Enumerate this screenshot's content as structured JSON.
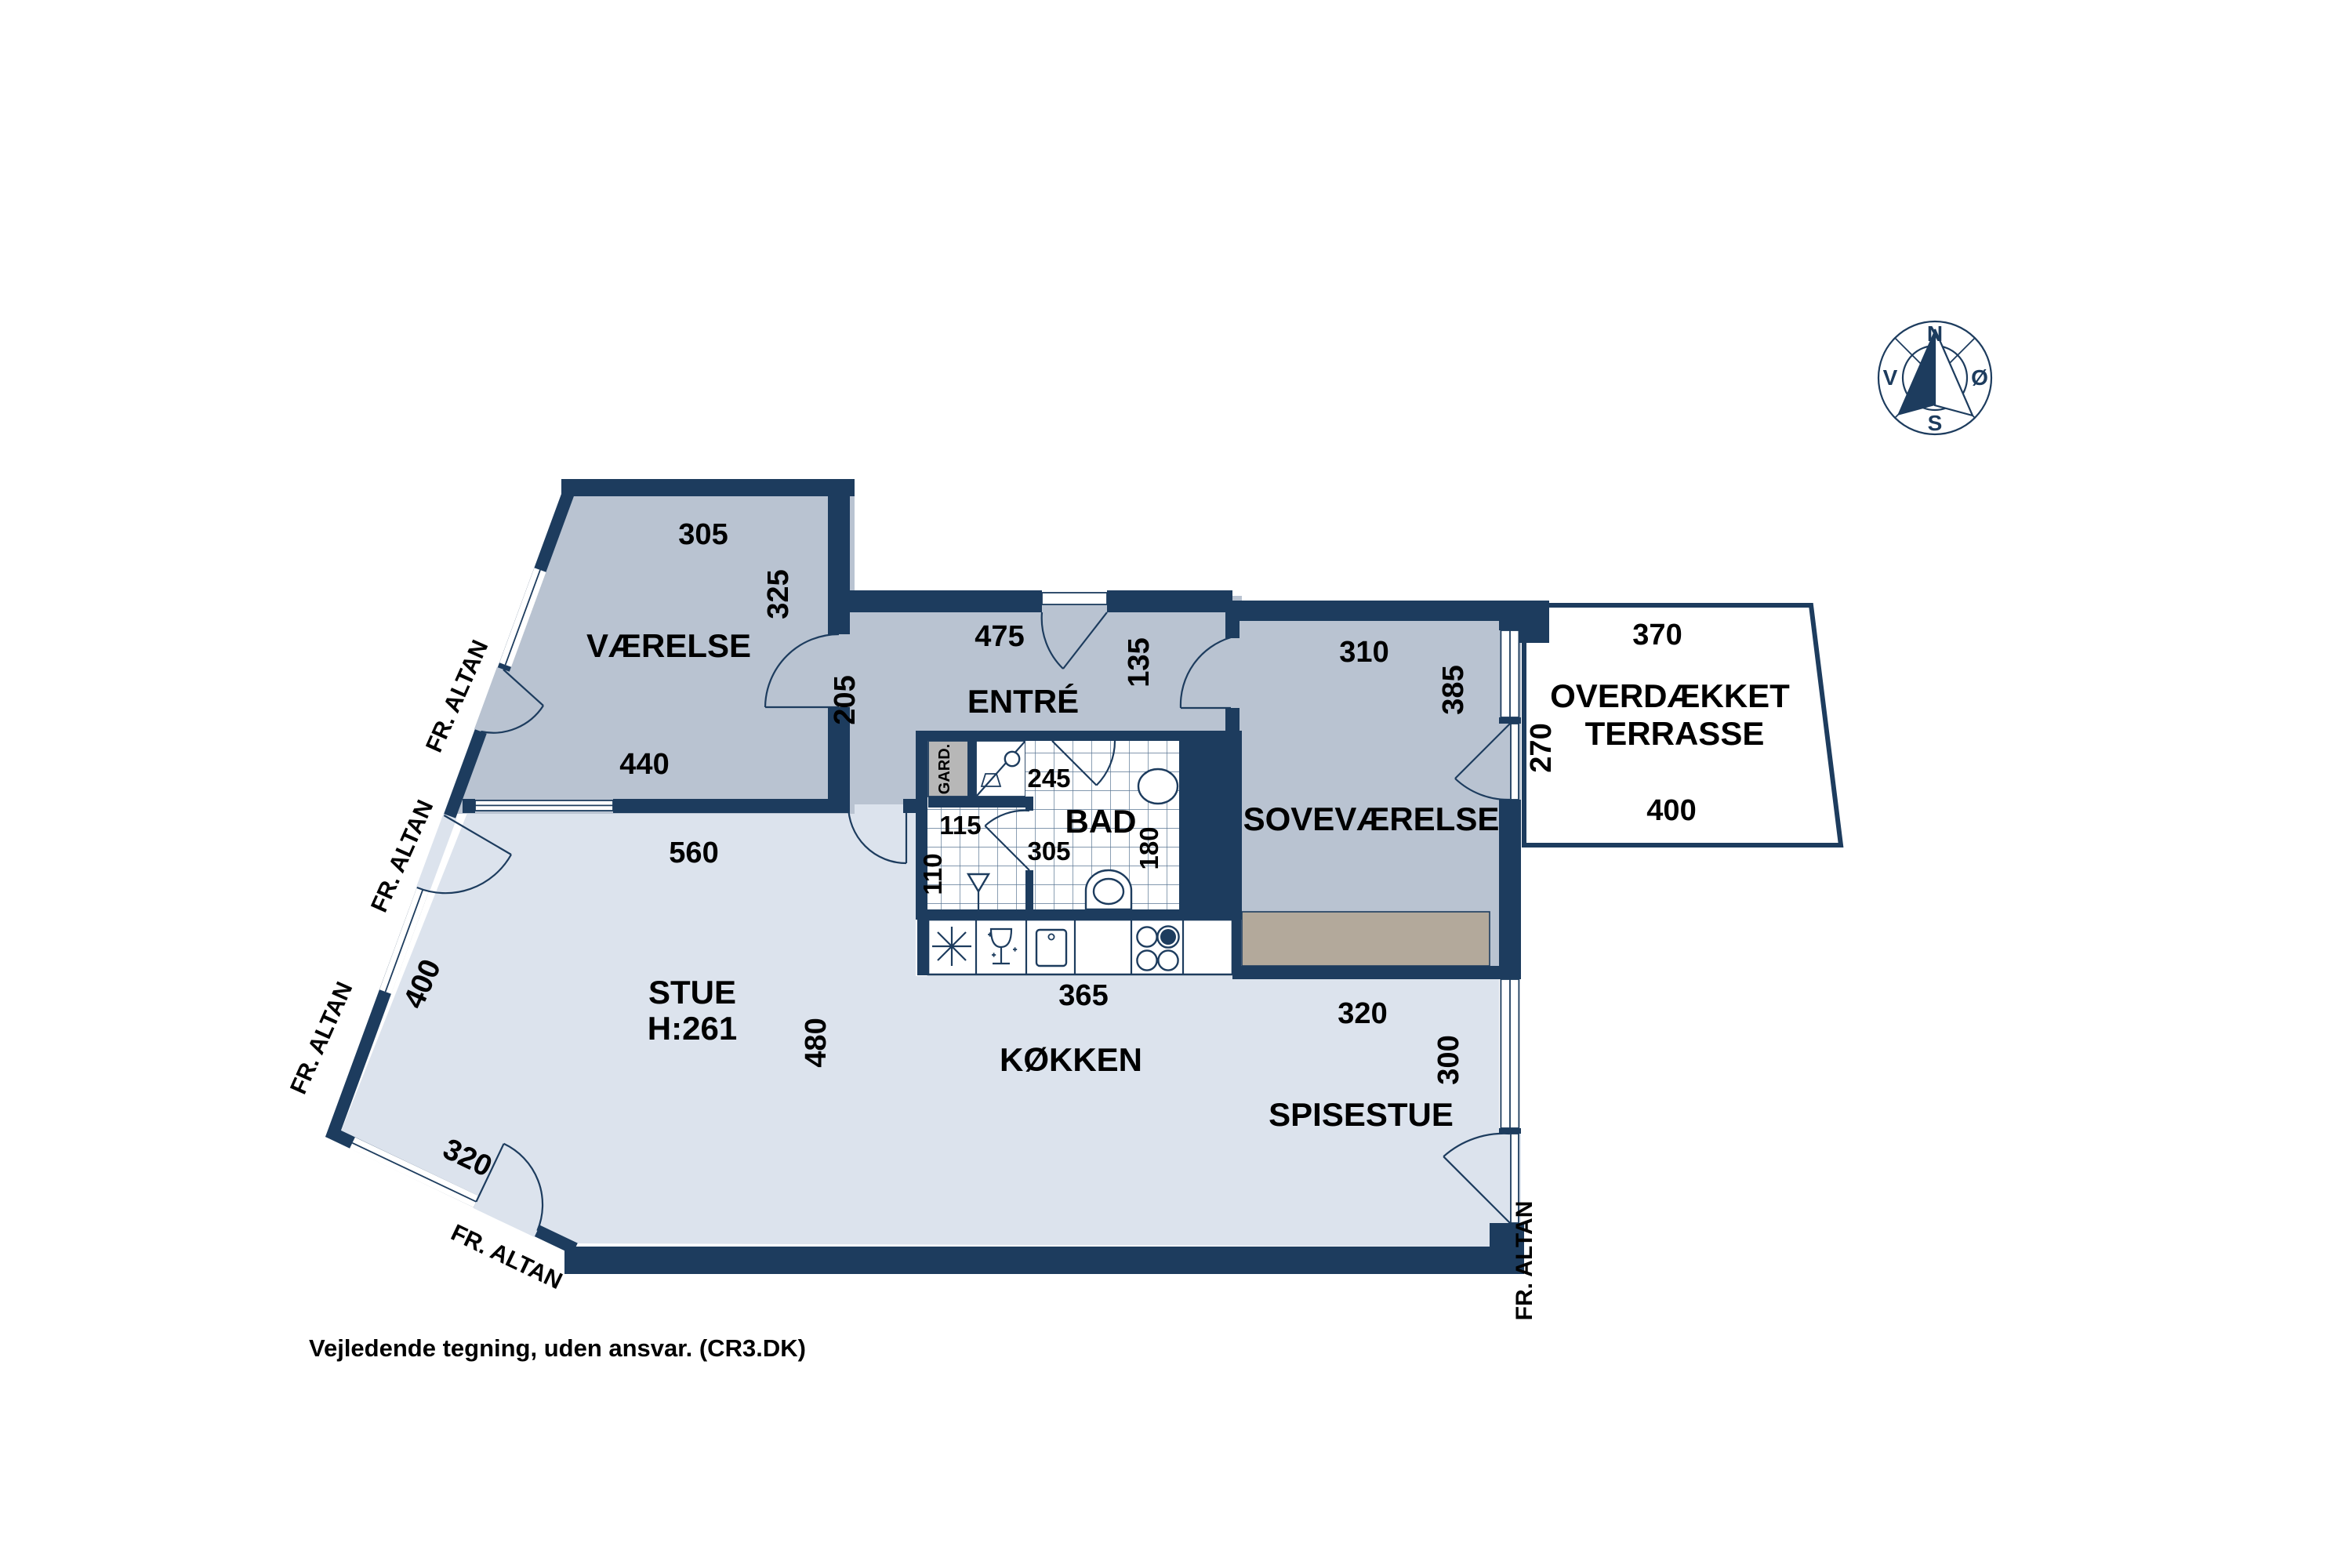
{
  "footer": "Vejledende tegning, uden ansvar. (CR3.DK)",
  "labels": {
    "fr_altan": "FR. ALTAN",
    "gard": "GARD."
  },
  "compass": {
    "n": "N",
    "e": "Ø",
    "s": "S",
    "w": "V"
  },
  "rooms": {
    "vaerelse": {
      "name": "VÆRELSE",
      "dim_top": "305",
      "dim_right": "325",
      "dim_bottom": "440",
      "dim_hall": "205"
    },
    "entre": {
      "name": "ENTRÉ",
      "dim_top": "475",
      "dim_right": "135"
    },
    "bad": {
      "name": "BAD",
      "dim_shower": "245",
      "dim_wc_w": "115",
      "dim_wc_h": "110",
      "dim_w": "305",
      "dim_h": "180"
    },
    "sovevaerelse": {
      "name": "SOVEVÆRELSE",
      "dim_top": "310",
      "dim_right": "385"
    },
    "terrasse": {
      "name_line1": "OVERDÆKKET",
      "name_line2": "TERRASSE",
      "dim_top": "370",
      "dim_left": "270",
      "dim_bottom": "400"
    },
    "stue": {
      "name": "STUE",
      "ceiling_height": "H:261",
      "dim_top": "560",
      "dim_mid": "480",
      "dim_diag_upper": "400",
      "dim_diag_lower": "320"
    },
    "koekken": {
      "name": "KØKKEN",
      "dim_top": "365"
    },
    "spisestue": {
      "name": "SPISESTUE",
      "dim_top": "320",
      "dim_right": "300"
    }
  },
  "colors": {
    "wall": "#1d3c5e",
    "floor_light": "#dce3ed",
    "floor_med": "#b9c3d1",
    "tan": "#b3a99b",
    "gray": "#b7b7b7"
  }
}
